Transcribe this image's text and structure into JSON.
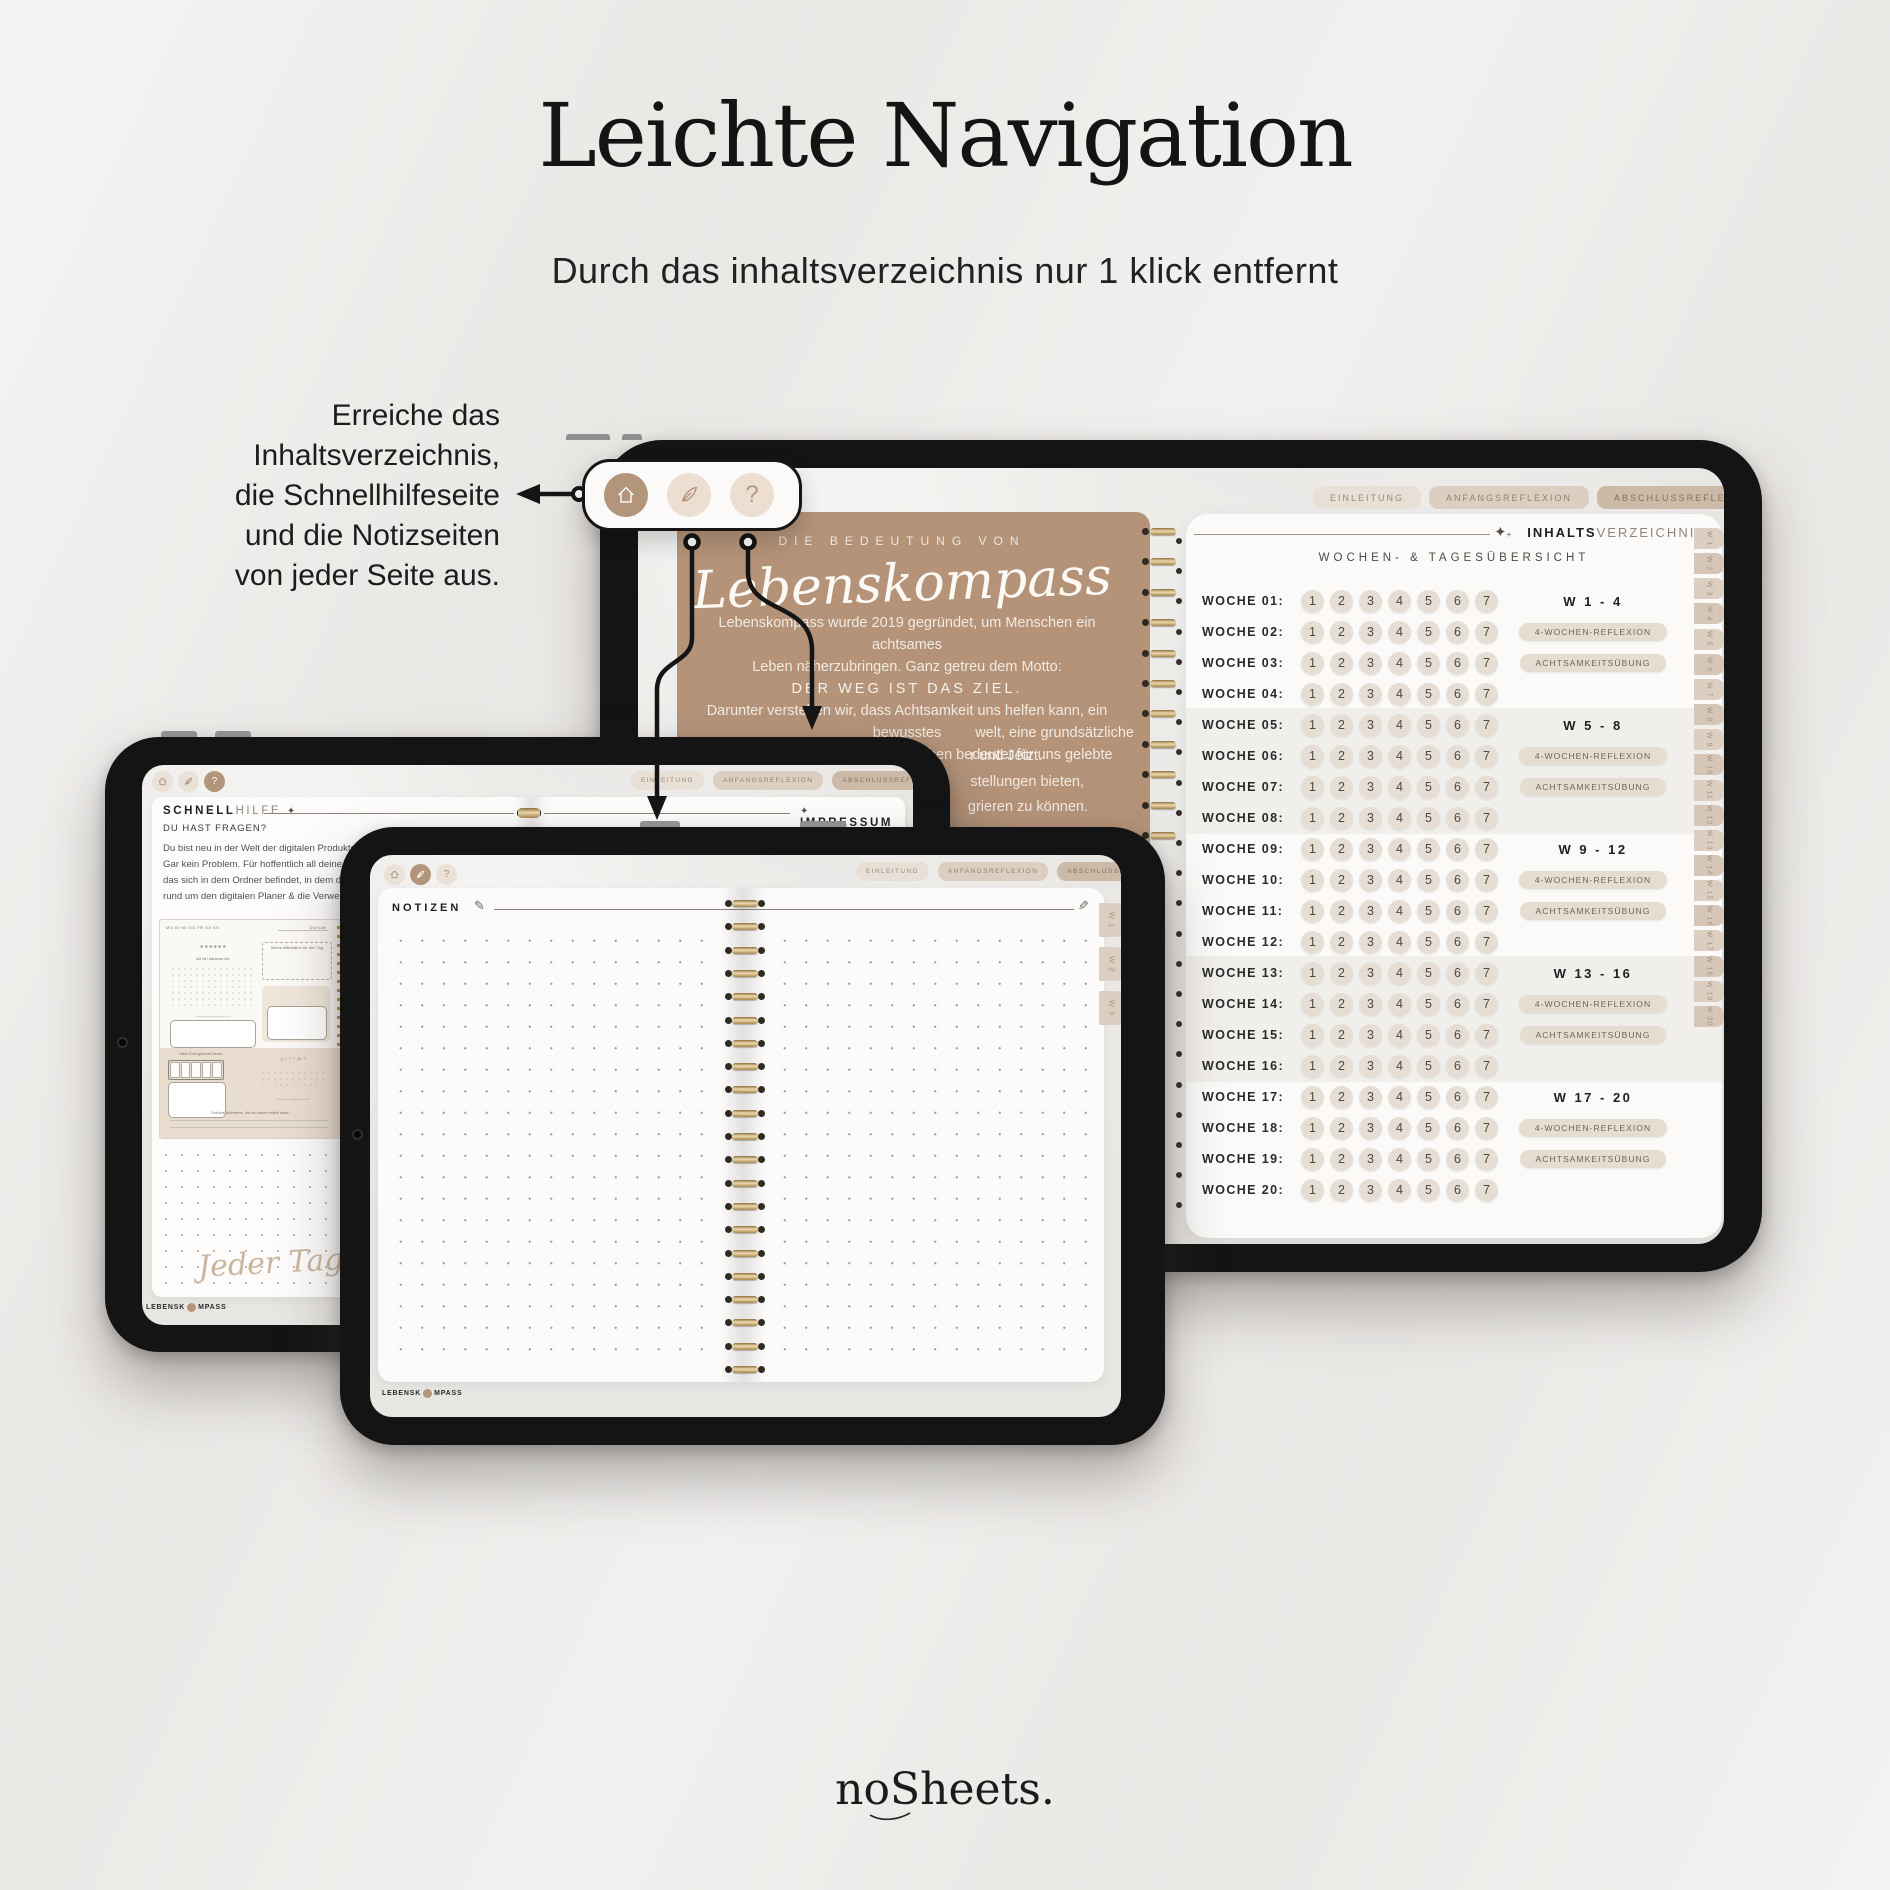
{
  "page": {
    "title": "Leichte Navigation",
    "subtitle": "Durch das inhaltsverzeichnis nur 1 klick entfernt",
    "brand": "noSheets."
  },
  "callout": {
    "lines": [
      "Erreiche das",
      "Inhaltsverzeichnis,",
      "die Schnellhilfeseite",
      "und die Notizseiten",
      "von jeder Seite aus."
    ]
  },
  "nav_panel": {
    "help_label": "?"
  },
  "planner_tabs": [
    "EINLEITUNG",
    "ANFANGSREFLEXION",
    "ABSCHLUSSREFLEXION"
  ],
  "big_tablet": {
    "brown_page": {
      "eyebrow": "DIE BEDEUTUNG VON",
      "script_title": "Lebenskompass",
      "lines": [
        "Lebenskompass wurde 2019 gegründet, um Menschen ein achtsames",
        "Leben näherzubringen. Ganz getreu dem Motto:",
        "DER WEG IST DAS ZIEL.",
        "Darunter verstehen wir, dass Achtsamkeit uns helfen kann, ein bewusstes",
        "Leben zu führen. Ein bewusstes Leben bedeutet für uns gelebte"
      ],
      "fragments": [
        "welt, eine grundsätzliche",
        "r und Jetzt.",
        "stellungen bieten,",
        "grieren zu können."
      ]
    },
    "toc": {
      "title_bold": "INHALTS",
      "title_light": "VERZEICHNIS",
      "subtitle": "WOCHEN- & TAGESÜBERSICHT",
      "days": [
        "1",
        "2",
        "3",
        "4",
        "5",
        "6",
        "7"
      ],
      "pill_reflexion": "4-WOCHEN-REFLEXION",
      "pill_achtsamkeit": "ACHTSAMKEITSÜBUNG",
      "rows": [
        {
          "label": "WOCHE 01:",
          "right_type": "group",
          "right_text": "W  1 - 4"
        },
        {
          "label": "WOCHE 02:",
          "right_type": "reflexion"
        },
        {
          "label": "WOCHE 03:",
          "right_type": "achtsamkeit"
        },
        {
          "label": "WOCHE 04:",
          "right_type": "none"
        },
        {
          "label": "WOCHE 05:",
          "right_type": "group",
          "right_text": "W  5 - 8"
        },
        {
          "label": "WOCHE 06:",
          "right_type": "reflexion"
        },
        {
          "label": "WOCHE 07:",
          "right_type": "achtsamkeit"
        },
        {
          "label": "WOCHE 08:",
          "right_type": "none"
        },
        {
          "label": "WOCHE 09:",
          "right_type": "group",
          "right_text": "W  9 - 12"
        },
        {
          "label": "WOCHE 10:",
          "right_type": "reflexion"
        },
        {
          "label": "WOCHE 11:",
          "right_type": "achtsamkeit"
        },
        {
          "label": "WOCHE 12:",
          "right_type": "none"
        },
        {
          "label": "WOCHE 13:",
          "right_type": "group",
          "right_text": "W  13 - 16"
        },
        {
          "label": "WOCHE 14:",
          "right_type": "reflexion"
        },
        {
          "label": "WOCHE 15:",
          "right_type": "achtsamkeit"
        },
        {
          "label": "WOCHE 16:",
          "right_type": "none"
        },
        {
          "label": "WOCHE 17:",
          "right_type": "group",
          "right_text": "W  17 - 20"
        },
        {
          "label": "WOCHE 18:",
          "right_type": "reflexion"
        },
        {
          "label": "WOCHE 19:",
          "right_type": "achtsamkeit"
        },
        {
          "label": "WOCHE 20:",
          "right_type": "none"
        }
      ],
      "side_tabs": [
        "W 1",
        "W 2",
        "W 3",
        "W 4",
        "W 5",
        "W 6",
        "W 7",
        "W 8",
        "W 9",
        "W 10",
        "W 11",
        "W 12",
        "W 13",
        "W 14",
        "W 15",
        "W 16",
        "W 17",
        "W 18",
        "W 19",
        "W 20"
      ]
    }
  },
  "schnellhilfe": {
    "title_bold": "SCHNELL",
    "title_light": "HILFE",
    "impressum": "IMPRESSUM",
    "question": "DU HAST FRAGEN?",
    "body_lines": [
      "Du bist neu in der Welt der digitalen Produkte oder blickst",
      "Gar kein Problem. Für hoffentlich all deine Fragen haben",
      "das sich in dem Ordner befindet, in dem du auch deine",
      "rund um den digitalen Planer & die Verwendung mit Go"
    ],
    "mini_page": {
      "days": "MO   DI   MI   DO   FR   SA   SO",
      "datum": "DATUM",
      "affirmation": "Meine Affirmation für den Tag",
      "dankbar": "Ich bin dankbar für:",
      "energie": "Mein Energielevel heute",
      "momente": "Schöne Momente, die ich heute erlebt habe"
    },
    "script_quote": "Jeder Tag ist ein",
    "logo_pre": "LEBENSK",
    "logo_post": "MPASS"
  },
  "notizen": {
    "title": "NOTIZEN",
    "side_tabs": [
      "W 1",
      "W 2",
      "W 3"
    ],
    "logo_pre": "LEBENSK",
    "logo_post": "MPASS"
  }
}
